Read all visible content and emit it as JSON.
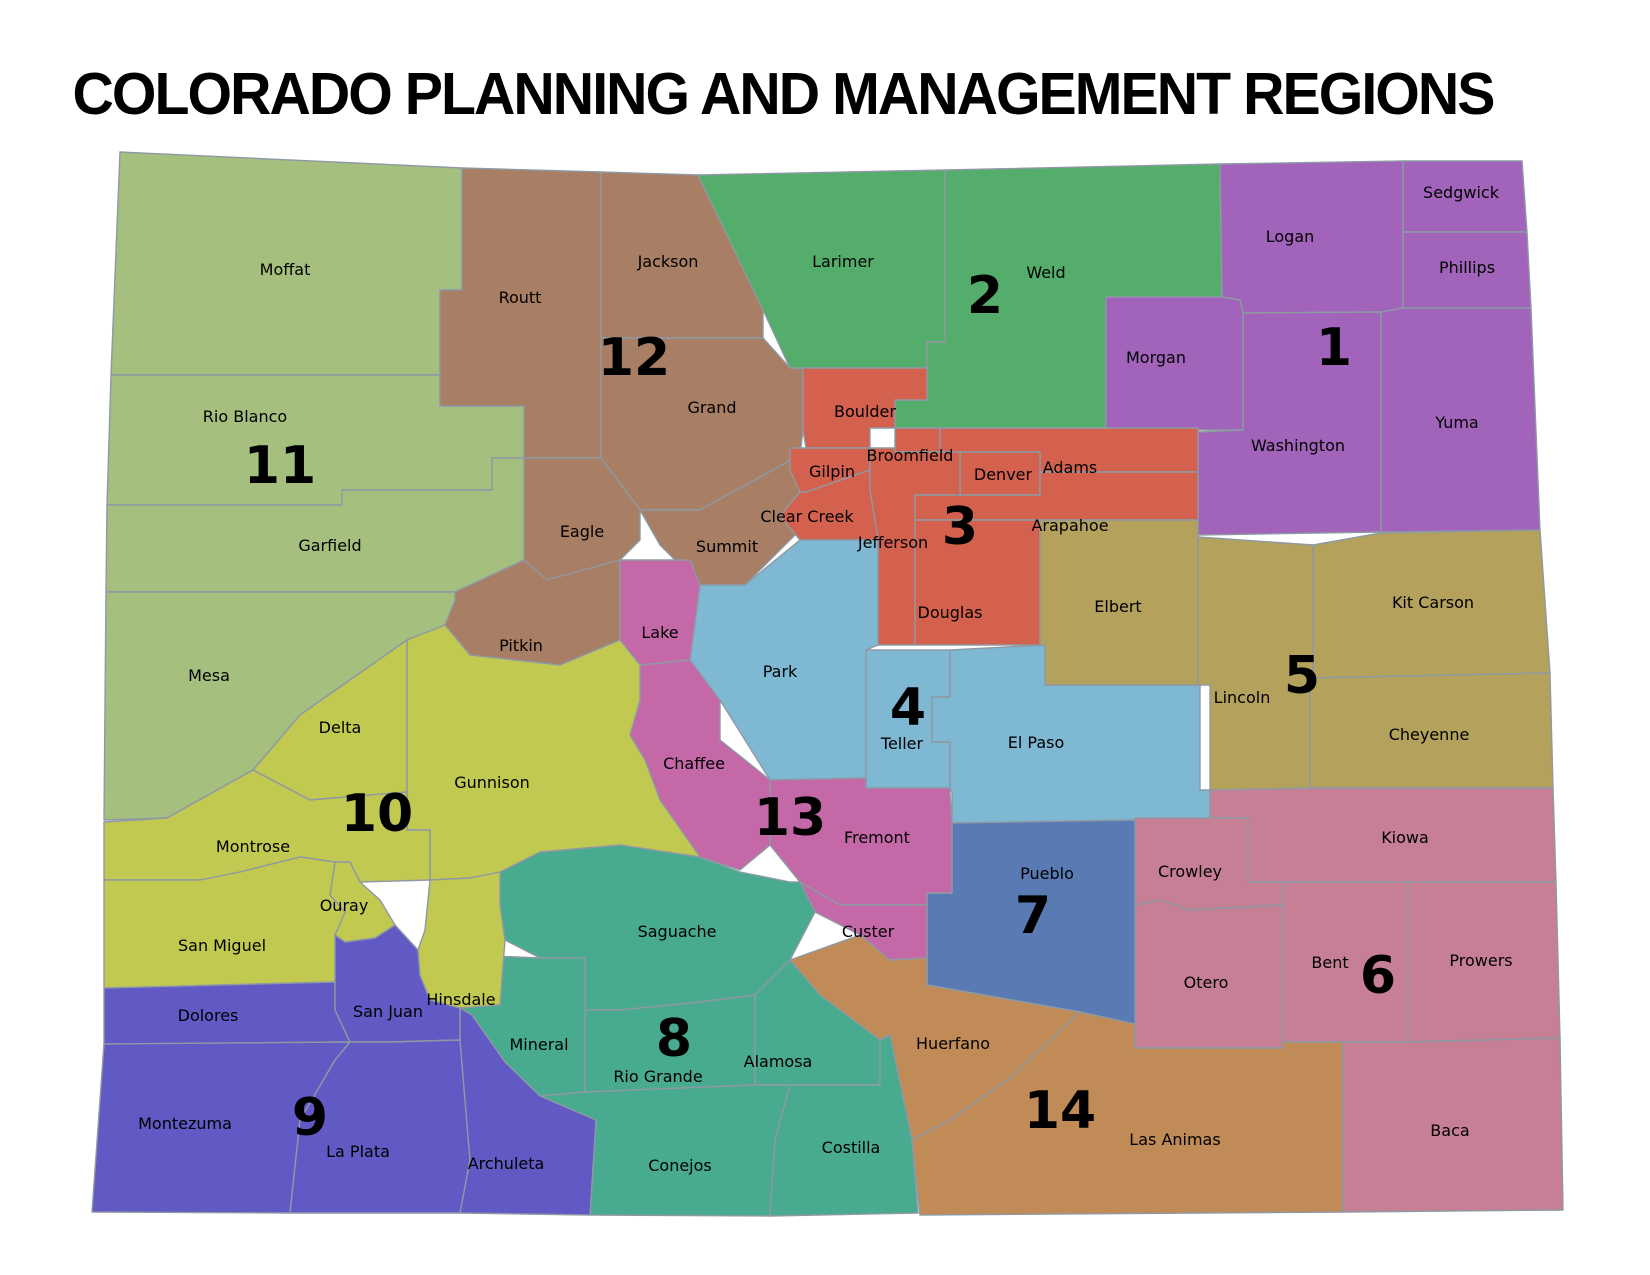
{
  "title": "COLORADO PLANNING AND MANAGEMENT REGIONS",
  "map": {
    "background": "#ffffff",
    "border_color": "#8e99a4",
    "label_color": "#000000",
    "regions": [
      {
        "number": "1",
        "color": "#a164ba",
        "number_pos": [
          1334,
          347
        ],
        "counties": [
          "Sedgwick",
          "Logan",
          "Phillips",
          "Morgan",
          "Washington",
          "Yuma"
        ]
      },
      {
        "number": "2",
        "color": "#54ad6b",
        "number_pos": [
          985,
          295
        ],
        "counties": [
          "Larimer",
          "Weld"
        ]
      },
      {
        "number": "3",
        "color": "#d4604e",
        "number_pos": [
          960,
          526
        ],
        "counties": [
          "Boulder",
          "Broomfield",
          "Gilpin",
          "Clear Creek",
          "Jefferson",
          "Denver",
          "Adams",
          "Arapahoe",
          "Douglas"
        ]
      },
      {
        "number": "4",
        "color": "#7fb8d3",
        "number_pos": [
          908,
          707
        ],
        "counties": [
          "Park",
          "Teller",
          "El Paso"
        ]
      },
      {
        "number": "5",
        "color": "#b3a15c",
        "number_pos": [
          1302,
          675
        ],
        "counties": [
          "Elbert",
          "Lincoln",
          "Kit Carson",
          "Cheyenne"
        ]
      },
      {
        "number": "6",
        "color": "#c67f95",
        "number_pos": [
          1378,
          975
        ],
        "counties": [
          "Kiowa",
          "Crowley",
          "Otero",
          "Bent",
          "Prowers",
          "Baca"
        ]
      },
      {
        "number": "7",
        "color": "#5a7ab4",
        "number_pos": [
          1033,
          915
        ],
        "counties": [
          "Pueblo"
        ]
      },
      {
        "number": "8",
        "color": "#48aa8e",
        "number_pos": [
          674,
          1038
        ],
        "counties": [
          "Saguache",
          "Mineral",
          "Rio Grande",
          "Alamosa",
          "Conejos",
          "Costilla"
        ]
      },
      {
        "number": "9",
        "color": "#6159c4",
        "number_pos": [
          310,
          1117
        ],
        "counties": [
          "Dolores",
          "San Juan",
          "Montezuma",
          "La Plata",
          "Archuleta"
        ]
      },
      {
        "number": "10",
        "color": "#c2c950",
        "number_pos": [
          377,
          813
        ],
        "counties": [
          "Delta",
          "Montrose",
          "Gunnison",
          "Ouray",
          "San Miguel",
          "Hinsdale"
        ]
      },
      {
        "number": "11",
        "color": "#a4bf7e",
        "number_pos": [
          280,
          465
        ],
        "counties": [
          "Moffat",
          "Rio Blanco",
          "Garfield",
          "Mesa"
        ]
      },
      {
        "number": "12",
        "color": "#a87e64",
        "number_pos": [
          634,
          357
        ],
        "counties": [
          "Routt",
          "Jackson",
          "Grand",
          "Eagle",
          "Summit",
          "Pitkin"
        ]
      },
      {
        "number": "13",
        "color": "#c568a8",
        "number_pos": [
          790,
          817
        ],
        "counties": [
          "Lake",
          "Chaffee",
          "Fremont",
          "Custer"
        ]
      },
      {
        "number": "14",
        "color": "#c08b57",
        "number_pos": [
          1060,
          1110
        ],
        "counties": [
          "Huerfano",
          "Las Animas"
        ]
      }
    ],
    "counties": [
      {
        "name": "Moffat",
        "region": "11",
        "label": [
          285,
          270
        ],
        "points": "120,152 462,168 462,290 440,290 440,375 111,375"
      },
      {
        "name": "Rio Blanco",
        "region": "11",
        "label": [
          245,
          417
        ],
        "points": "111,375 440,375 440,406 524,406 524,458 492,458 492,490 342,490 342,505 107,505"
      },
      {
        "name": "Garfield",
        "region": "11",
        "label": [
          330,
          546
        ],
        "points": "107,505 342,505 342,490 492,490 492,458 524,458 524,560 455,592 106,592"
      },
      {
        "name": "Mesa",
        "region": "11",
        "label": [
          209,
          676
        ],
        "points": "106,592 455,592 455,640 407,640 350,680 300,715 253,770 167,818 104,820"
      },
      {
        "name": "Routt",
        "region": "12",
        "label": [
          520,
          298
        ],
        "points": "462,168 601,172 601,458 524,458 524,406 440,406 440,290 462,290"
      },
      {
        "name": "Jackson",
        "region": "12",
        "label": [
          668,
          262
        ],
        "points": "601,172 698,175 763,310 763,338 601,338"
      },
      {
        "name": "Grand",
        "region": "12",
        "label": [
          712,
          408
        ],
        "points": "601,338 763,338 790,368 803,368 803,430 800,455 700,510 640,510 601,458"
      },
      {
        "name": "Eagle",
        "region": "12",
        "label": [
          582,
          532
        ],
        "points": "524,458 601,458 640,510 640,540 620,560 547,580 524,560"
      },
      {
        "name": "Summit",
        "region": "12",
        "label": [
          727,
          547
        ],
        "points": "640,510 700,510 800,455 800,530 745,585 700,585 660,545"
      },
      {
        "name": "Pitkin",
        "region": "12",
        "label": [
          521,
          646
        ],
        "points": "455,592 524,560 547,580 620,560 620,640 560,665 470,655 445,625 455,600"
      },
      {
        "name": "Larimer",
        "region": "2",
        "label": [
          843,
          262
        ],
        "points": "698,175 945,170 945,342 927,342 927,368 803,368 790,368 763,310"
      },
      {
        "name": "Weld",
        "region": "2",
        "label": [
          1046,
          273
        ],
        "points": "945,170 1220,164 1222,297 1106,297 1106,428 895,428 895,400 927,400 927,342 945,342"
      },
      {
        "name": "Logan",
        "region": "1",
        "label": [
          1290,
          237
        ],
        "points": "1220,164 1403,161 1403,308 1381,312 1243,313 1240,300 1222,297"
      },
      {
        "name": "Sedgwick",
        "region": "1",
        "label": [
          1461,
          193
        ],
        "points": "1403,161 1522,161 1527,232 1403,232"
      },
      {
        "name": "Phillips",
        "region": "1",
        "label": [
          1467,
          268
        ],
        "points": "1403,232 1527,232 1531,308 1403,308"
      },
      {
        "name": "Morgan",
        "region": "1",
        "label": [
          1156,
          358
        ],
        "points": "1106,297 1222,297 1240,300 1243,313 1243,430 1106,430"
      },
      {
        "name": "Washington",
        "region": "1",
        "label": [
          1298,
          446
        ],
        "points": "1243,313 1381,312 1381,532 1198,535 1198,432 1243,430"
      },
      {
        "name": "Yuma",
        "region": "1",
        "label": [
          1457,
          423
        ],
        "points": "1381,312 1403,308 1531,308 1540,530 1381,532"
      },
      {
        "name": "Boulder",
        "region": "3",
        "label": [
          865,
          412
        ],
        "points": "803,368 927,368 927,400 895,400 895,428 870,428 870,448 806,448 803,430"
      },
      {
        "name": "Gilpin",
        "region": "3",
        "label": [
          832,
          472
        ],
        "points": "790,448 870,448 870,470 806,492 800,492 790,470"
      },
      {
        "name": "Clear Creek",
        "region": "3",
        "label": [
          807,
          517
        ],
        "points": "800,492 806,492 870,470 880,490 880,540 800,540 780,516"
      },
      {
        "name": "Adams",
        "region": "3",
        "label": [
          1070,
          468
        ],
        "points": "940,428 1198,428 1198,472 1040,472 1040,452 940,452"
      },
      {
        "name": "Broomfield",
        "region": "3",
        "label": [
          910,
          456
        ],
        "points": "895,428 940,428 940,452 895,452"
      },
      {
        "name": "Denver",
        "region": "3",
        "label": [
          1003,
          475
        ],
        "points": "960,452 1040,452 1040,495 960,495"
      },
      {
        "name": "Jefferson",
        "region": "3",
        "label": [
          893,
          543
        ],
        "points": "870,448 895,448 895,452 960,452 960,495 915,495 915,645 878,645 878,540 870,490"
      },
      {
        "name": "Arapahoe",
        "region": "3",
        "label": [
          1070,
          526
        ],
        "points": "915,495 1040,495 1040,472 1198,472 1198,520 915,520"
      },
      {
        "name": "Douglas",
        "region": "3",
        "label": [
          950,
          613
        ],
        "points": "915,520 1040,520 1040,645 915,645"
      },
      {
        "name": "Park",
        "region": "4",
        "label": [
          780,
          672
        ],
        "points": "700,585 745,585 800,540 878,540 878,645 866,650 866,778 770,780 720,700 700,690 690,660"
      },
      {
        "name": "Teller",
        "region": "4",
        "label": [
          902,
          744
        ],
        "points": "866,650 950,650 950,697 932,697 932,742 950,742 950,788 866,788"
      },
      {
        "name": "El Paso",
        "region": "4",
        "label": [
          1036,
          743
        ],
        "points": "950,650 1045,645 1045,685 1200,685 1200,790 1210,790 1210,818 1135,820 952,823 952,793 950,788 950,742 932,742 932,697 950,697"
      },
      {
        "name": "Elbert",
        "region": "5",
        "label": [
          1118,
          607
        ],
        "points": "1040,520 1198,520 1198,685 1045,685 1045,645 1040,645"
      },
      {
        "name": "Lincoln",
        "region": "5",
        "label": [
          1242,
          698
        ],
        "points": "1198,537 1313,545 1313,678 1310,678 1310,790 1210,790 1210,685 1198,685"
      },
      {
        "name": "Kit Carson",
        "region": "5",
        "label": [
          1433,
          603
        ],
        "points": "1313,545 1381,533 1540,530 1550,673 1313,678"
      },
      {
        "name": "Cheyenne",
        "region": "5",
        "label": [
          1429,
          735
        ],
        "points": "1313,678 1550,673 1553,788 1310,788 1310,678"
      },
      {
        "name": "Kiowa",
        "region": "6",
        "label": [
          1405,
          838
        ],
        "points": "1210,790 1310,788 1553,788 1556,882 1248,882 1248,818 1210,818"
      },
      {
        "name": "Crowley",
        "region": "6",
        "label": [
          1190,
          872
        ],
        "points": "1135,818 1248,818 1248,882 1283,882 1283,905 1190,910 1160,900 1135,905"
      },
      {
        "name": "Otero",
        "region": "6",
        "label": [
          1206,
          983
        ],
        "points": "1135,905 1160,900 1190,910 1283,905 1283,1048 1135,1048"
      },
      {
        "name": "Bent",
        "region": "6",
        "label": [
          1330,
          963
        ],
        "points": "1283,882 1408,882 1408,1042 1283,1042 1283,905"
      },
      {
        "name": "Prowers",
        "region": "6",
        "label": [
          1481,
          961
        ],
        "points": "1408,882 1556,882 1560,1038 1408,1042"
      },
      {
        "name": "Baca",
        "region": "6",
        "label": [
          1450,
          1131
        ],
        "points": "1343,1042 1408,1042 1560,1038 1563,1210 1343,1212"
      },
      {
        "name": "Pueblo",
        "region": "7",
        "label": [
          1047,
          874
        ],
        "points": "952,823 1135,820 1135,1024 1080,1012 927,985 927,893 952,893"
      },
      {
        "name": "Lake",
        "region": "13",
        "label": [
          660,
          633
        ],
        "points": "620,560 690,560 700,585 690,660 640,665 620,640"
      },
      {
        "name": "Chaffee",
        "region": "13",
        "label": [
          694,
          764
        ],
        "points": "640,665 690,660 720,700 720,740 770,780 770,845 740,870 700,857 660,800 645,760 630,735 640,700"
      },
      {
        "name": "Fremont",
        "region": "13",
        "label": [
          877,
          838
        ],
        "points": "770,780 866,778 866,788 950,788 950,793 952,823 952,893 927,893 927,905 840,905 800,882 770,845"
      },
      {
        "name": "Custer",
        "region": "13",
        "label": [
          868,
          932
        ],
        "points": "800,882 840,905 927,905 927,958 890,960 860,935 815,912"
      },
      {
        "name": "Huerfano",
        "region": "14",
        "label": [
          953,
          1044
        ],
        "points": "790,960 860,935 890,960 927,958 927,985 1080,1012 1010,1078 950,1120 912,1140 890,1035 880,1040 820,995 790,978"
      },
      {
        "name": "Las Animas",
        "region": "14",
        "label": [
          1175,
          1140
        ],
        "points": "1080,1012 1135,1024 1135,1048 1283,1048 1283,1042 1343,1042 1343,1212 920,1215 912,1140 950,1120 1010,1078"
      },
      {
        "name": "Saguache",
        "region": "8",
        "label": [
          677,
          932
        ],
        "points": "500,872 540,852 620,845 700,857 740,872 790,882 800,882 815,912 790,960 755,995 700,1002 620,1010 585,1010 585,958 540,958 505,940 500,905"
      },
      {
        "name": "Mineral",
        "region": "8",
        "label": [
          539,
          1045
        ],
        "points": "470,955 540,958 585,958 585,1010 585,1092 540,1096 505,1062 472,1015 460,1008 465,980"
      },
      {
        "name": "Rio Grande",
        "region": "8",
        "label": [
          658,
          1077
        ],
        "points": "585,1010 620,1010 700,1002 755,995 755,1085 585,1092"
      },
      {
        "name": "Alamosa",
        "region": "8",
        "label": [
          778,
          1062
        ],
        "points": "755,995 790,960 820,995 880,1040 880,1085 755,1085"
      },
      {
        "name": "Conejos",
        "region": "8",
        "label": [
          680,
          1166
        ],
        "points": "540,1096 585,1092 755,1085 790,1085 775,1140 770,1216 590,1215 596,1120"
      },
      {
        "name": "Costilla",
        "region": "8",
        "label": [
          851,
          1148
        ],
        "points": "790,1085 880,1085 880,1040 890,1035 912,1140 918,1213 770,1216 775,1140"
      },
      {
        "name": "Delta",
        "region": "10",
        "label": [
          340,
          728
        ],
        "points": "407,640 350,680 300,715 253,770 310,800 407,792"
      },
      {
        "name": "Gunnison",
        "region": "10",
        "label": [
          492,
          783
        ],
        "points": "407,640 445,625 470,655 560,665 620,640 640,665 640,700 630,735 645,760 660,800 700,857 620,845 540,852 500,872 470,878 430,880 430,830 407,830 407,792"
      },
      {
        "name": "Montrose",
        "region": "10",
        "label": [
          253,
          847
        ],
        "points": "167,818 253,770 310,800 407,792 407,830 430,830 430,880 360,882 350,862 335,862 300,857 240,872 200,880 104,880 104,822"
      },
      {
        "name": "Ouray",
        "region": "10",
        "label": [
          344,
          906
        ],
        "points": "335,862 350,862 360,882 380,900 395,925 375,938 345,942 335,935 345,912 330,895"
      },
      {
        "name": "San Miguel",
        "region": "10",
        "label": [
          222,
          946
        ],
        "points": "104,880 200,880 240,872 300,857 335,862 330,895 345,912 335,935 335,982 104,988"
      },
      {
        "name": "Hinsdale",
        "region": "10",
        "label": [
          461,
          1000
        ],
        "points": "418,950 425,930 430,880 470,878 500,872 500,905 505,940 500,1005 460,1008 430,1000 420,975"
      },
      {
        "name": "Dolores",
        "region": "9",
        "label": [
          208,
          1016
        ],
        "points": "104,988 335,982 335,1010 350,1042 104,1044"
      },
      {
        "name": "San Juan",
        "region": "9",
        "label": [
          388,
          1012
        ],
        "points": "335,982 335,935 345,942 375,938 395,925 418,950 420,975 430,1000 460,1008 460,1040 390,1042 350,1042 335,1010"
      },
      {
        "name": "Montezuma",
        "region": "9",
        "label": [
          185,
          1124
        ],
        "points": "104,1044 350,1042 335,1060 300,1120 290,1213 92,1212"
      },
      {
        "name": "La Plata",
        "region": "9",
        "label": [
          358,
          1152
        ],
        "points": "350,1042 390,1042 460,1040 470,1160 460,1213 290,1213 300,1120 335,1060"
      },
      {
        "name": "Archuleta",
        "region": "9",
        "label": [
          506,
          1164
        ],
        "points": "460,1040 460,1008 472,1015 505,1062 540,1096 596,1120 590,1215 460,1213 470,1160"
      }
    ]
  }
}
